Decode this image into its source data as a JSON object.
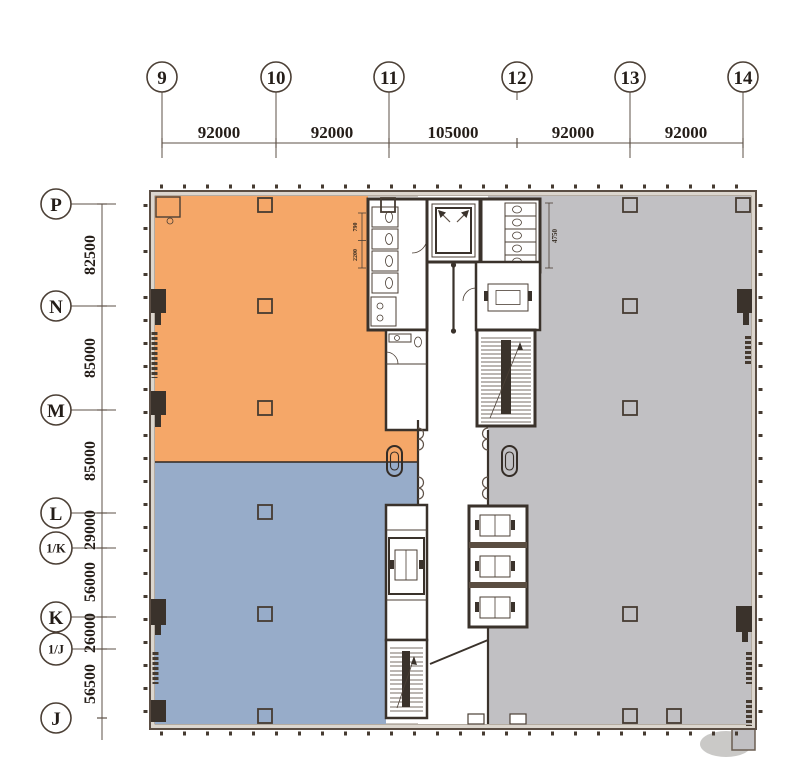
{
  "drawing_type": "architectural floor plan",
  "grid": {
    "columns": [
      "9",
      "10",
      "11",
      "12",
      "13",
      "14"
    ],
    "column_dims": [
      "92000",
      "92000",
      "105000",
      "92000",
      "92000"
    ],
    "rows": [
      "P",
      "N",
      "M",
      "L",
      "1/K",
      "K",
      "1/J",
      "J"
    ],
    "row_dims": [
      "82500",
      "85000",
      "85000",
      "29000",
      "56000",
      "26000",
      "56500"
    ]
  },
  "interior_dims": {
    "toilet_right": "4750",
    "toilet_left_upper": "790",
    "toilet_left_lower": "2200"
  },
  "zones": [
    {
      "name": "northwest tenant zone",
      "color": "#F5A768"
    },
    {
      "name": "southwest tenant zone",
      "color": "#97ACC9"
    },
    {
      "name": "east tenant zone",
      "color": "#C1C0C3"
    }
  ],
  "colors": {
    "zone_orange": "#F5A768",
    "zone_blue": "#97ACC9",
    "zone_gray": "#C1C0C3",
    "wall_fill": "#DCD6CE",
    "wall_dark": "#3A322B",
    "line": "#5E5147"
  }
}
